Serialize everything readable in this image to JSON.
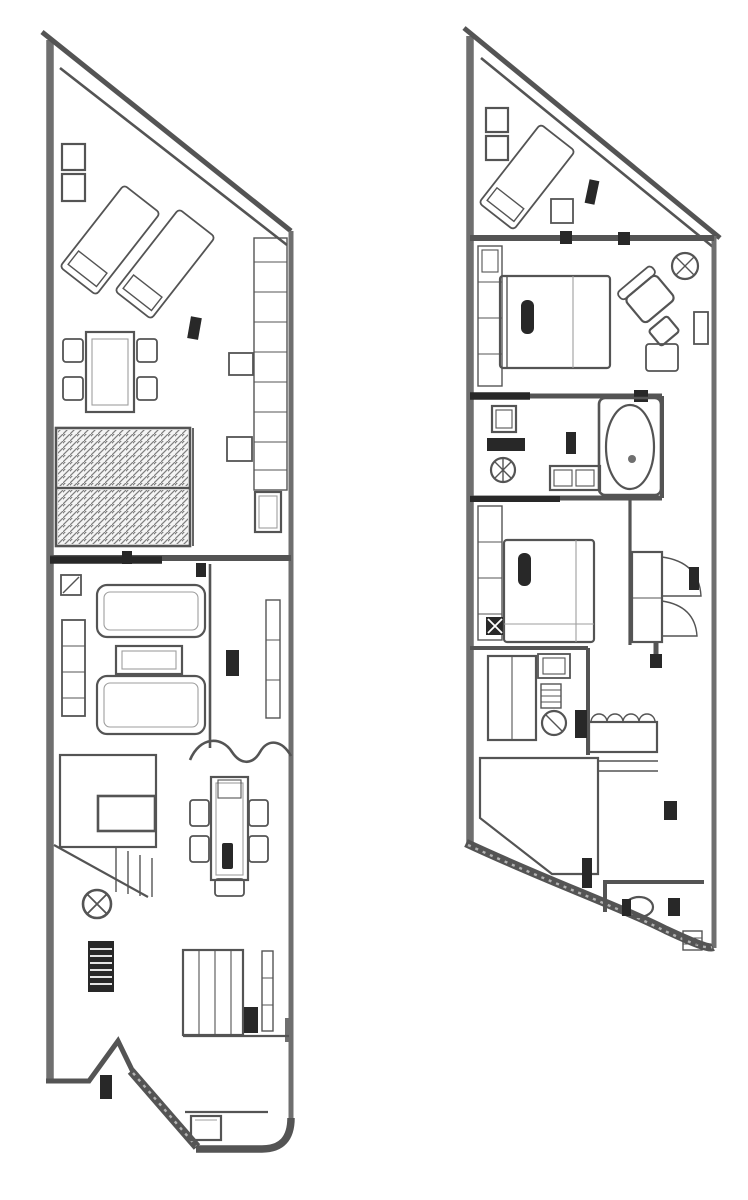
{
  "page": {
    "kind": "scanned hand-drawn architectural floor plan, grayscale",
    "background": "#ffffff"
  },
  "palette": {
    "ink": "#555555",
    "ink_dark": "#2a2a2a",
    "ink_mid": "#6f6f6f",
    "ink_light": "#9d9d9d",
    "weave_fill": "#d0d0d0",
    "weave_line": "#8e8e8e",
    "paper": "#ffffff"
  },
  "plans": [
    {
      "id": "plan-living-level",
      "position": "left",
      "shape": "narrow plot, sloped party wall at top, angled entry at bottom",
      "areas": [
        "roof-terrace",
        "outdoor-dining",
        "slatted-pergola-deck",
        "living-room",
        "stair-hall",
        "dining-area",
        "kitchen",
        "entry"
      ],
      "furniture": [
        "planter-box",
        "planter-box",
        "sun-lounger",
        "sun-lounger",
        "outdoor-table",
        "outdoor-chair",
        "outdoor-chair",
        "outdoor-chair",
        "outdoor-chair",
        "door-leaf-marker",
        "slatted-deck-panel",
        "slatted-deck-panel",
        "railing-shelf",
        "side-table",
        "side-table",
        "wall-cabinet",
        "floor-drain",
        "bookshelf",
        "sofa",
        "sofa",
        "coffee-table",
        "media-cabinet",
        "door-marker",
        "staircase",
        "stair-landing",
        "column-light",
        "radiator",
        "dining-table",
        "dining-chair",
        "dining-chair",
        "dining-chair",
        "dining-chair",
        "dining-chair",
        "kitchen-cabinet-run",
        "appliance",
        "wall-shelf",
        "entry-mat",
        "door-leaf-marker"
      ]
    },
    {
      "id": "plan-bedroom-level",
      "position": "right",
      "shape": "narrow plot, sloped party wall at top, curved wall at bottom",
      "areas": [
        "terrace",
        "bedroom-1",
        "bathroom-1",
        "bedroom-2",
        "bathroom-2",
        "corridor",
        "stair-hall",
        "wc"
      ],
      "furniture": [
        "planter-box",
        "planter-box",
        "sun-lounger",
        "side-table",
        "door-leaf-marker",
        "closet-run",
        "double-bed",
        "pillow",
        "ceiling-light",
        "armchair",
        "ottoman",
        "rug",
        "side-table",
        "washer-unit",
        "toilet",
        "vanity-double-basin",
        "bathtub",
        "closet-run",
        "nightstand",
        "double-bed",
        "pillow",
        "wardrobe",
        "folding-door",
        "door-marker",
        "shower-enclosure",
        "washbasin",
        "towel-radiator",
        "toilet",
        "towel-shelf-counter",
        "staircase",
        "door-marker",
        "door-leaf-marker",
        "toilet",
        "door-marker",
        "shelf-unit"
      ]
    }
  ]
}
